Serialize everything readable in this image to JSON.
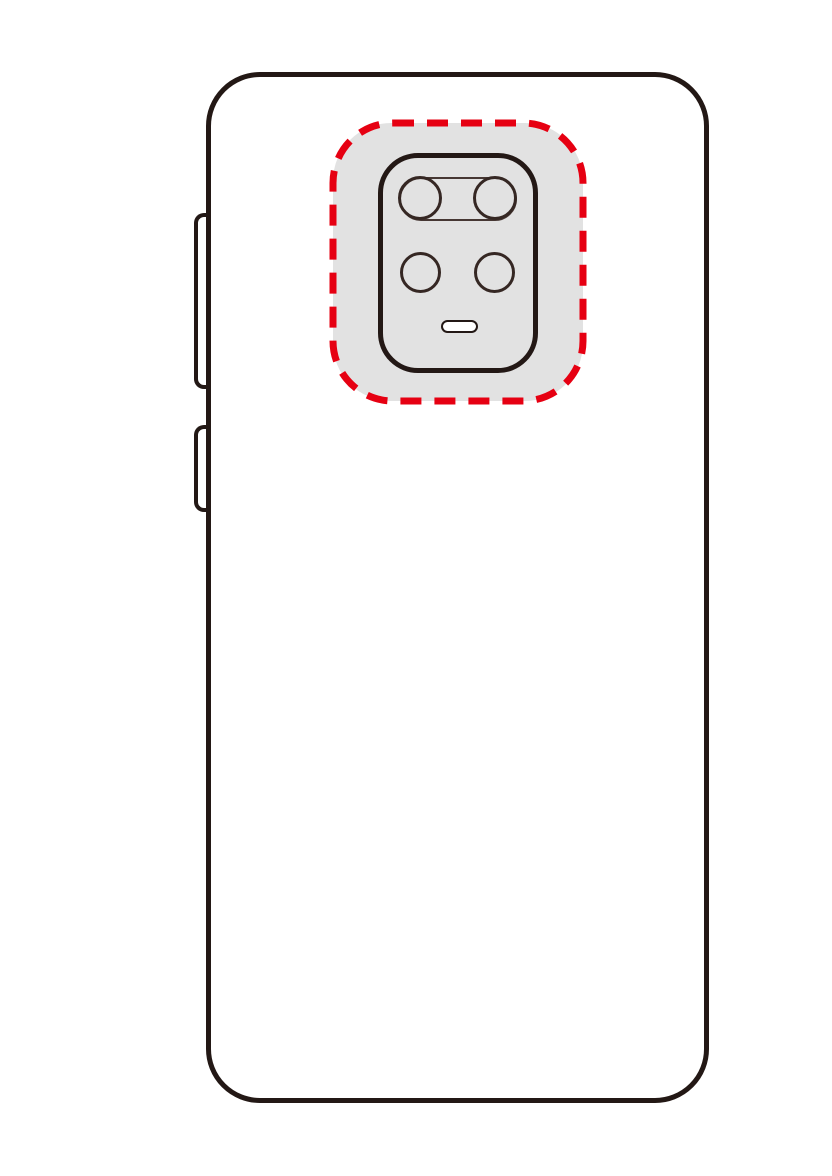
{
  "illustration": {
    "title": "smartphone-rear-view-camera-highlight",
    "description": "Line-art back view of a smartphone; rear camera module area highlighted with a red dashed rounded rectangle over a gray rounded square",
    "colors": {
      "outline": "#231815",
      "highlight_red": "#e60012",
      "camera_area_gray": "#e2e2e2",
      "background": "#ffffff",
      "flash_fill": "#ffffff"
    },
    "phone": {
      "view": "rear",
      "side_buttons": [
        "volume-rocker",
        "power-button"
      ]
    },
    "camera_module": {
      "lens_count": 4,
      "top_row": "dual-lens pill",
      "bottom_row": "two separate lenses",
      "flash_count": 1
    },
    "highlight": {
      "style": "dashed",
      "dash_length": 21,
      "dash_gap": 13,
      "stroke_width": 7
    }
  }
}
